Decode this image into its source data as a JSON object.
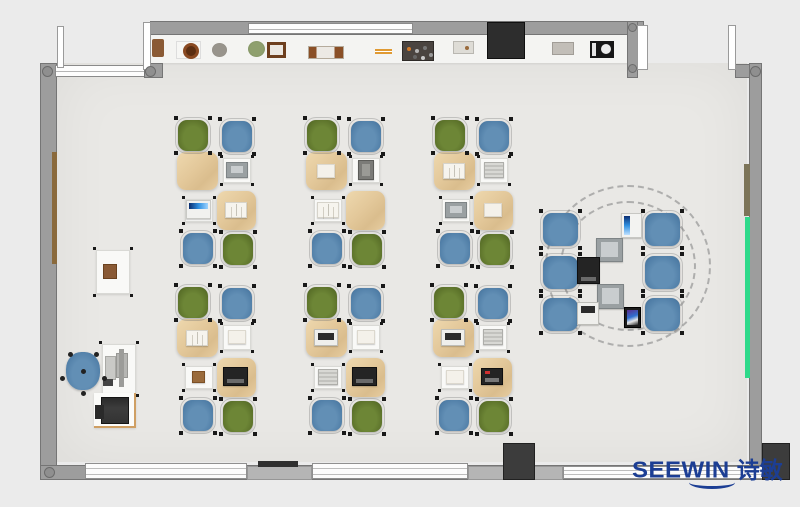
{
  "logo": {
    "en": "SEEWIN",
    "cn": "诗敏",
    "color": "#1c3e94"
  },
  "palette": {
    "background": "#ebebeb",
    "floor": "#e9e8e5",
    "wall": "#9d9d9d",
    "wall_dark": "#3c3c3c",
    "chair_green": "#62792e",
    "chair_blue": "#5585ad",
    "desk_tan": "#e5cba0",
    "desk_white": "#f9f9f7",
    "board_green": "#2ed98a",
    "board_brown": "#8a6a3c",
    "logo_blue": "#1c3e94"
  },
  "floor_rects": [
    {
      "name": "room-floor",
      "cls": "floor",
      "x": 57,
      "y": 63,
      "w": 690,
      "h": 399
    },
    {
      "name": "top-shelf-band",
      "cls": "shelfband",
      "x": 150,
      "y": 35,
      "w": 480,
      "h": 28
    }
  ],
  "zone_circles": [
    {
      "name": "collab-zone-outline-outer",
      "x": 545,
      "y": 185,
      "w": 166,
      "h": 162
    },
    {
      "name": "collab-zone-outline-inner",
      "x": 560,
      "y": 201,
      "w": 136,
      "h": 130
    }
  ],
  "cluster_template": {
    "chair_w": 30,
    "chair_h": 31,
    "chairs": [
      {
        "dx": 1,
        "dy": 2,
        "color": "green"
      },
      {
        "dx": 45,
        "dy": 3,
        "color": "blue"
      },
      {
        "dx": 6,
        "dy": 115,
        "color": "blue"
      },
      {
        "dx": 46,
        "dy": 116,
        "color": "green"
      }
    ],
    "desks": [
      {
        "dx": 0,
        "dy": 34,
        "w": 41,
        "h": 38,
        "kind": "tan"
      },
      {
        "dx": 46,
        "dy": 40,
        "w": 28,
        "h": 25,
        "kind": "white"
      },
      {
        "dx": 8,
        "dy": 81,
        "w": 28,
        "h": 23,
        "kind": "white"
      },
      {
        "dx": 40,
        "dy": 73,
        "w": 39,
        "h": 39,
        "kind": "tan"
      }
    ],
    "slots": {
      "tl": [
        20,
        53
      ],
      "tr": [
        60,
        52
      ],
      "bl": [
        22,
        92
      ],
      "br": [
        59,
        92
      ]
    },
    "device_sizes": {
      "default": [
        21,
        15
      ],
      "laptop-dark": [
        25,
        19
      ],
      "laptop-dark-red": [
        22,
        17
      ],
      "laptop-blue": [
        25,
        19
      ],
      "laptop-white": [
        24,
        17
      ],
      "laptop-gray": [
        22,
        16
      ],
      "book": [
        22,
        16
      ],
      "book-gray": [
        20,
        16
      ],
      "paper": [
        18,
        14
      ],
      "paper-small": [
        13,
        12
      ],
      "tablet-dark": [
        16,
        20
      ]
    }
  },
  "clusters": [
    {
      "x": 177,
      "y": 118,
      "devices": {
        "tr": "laptop-gray",
        "bl": "laptop-blue",
        "br": "book"
      }
    },
    {
      "x": 306,
      "y": 118,
      "devices": {
        "tl": "paper",
        "tr": "tablet-dark",
        "bl": "book"
      }
    },
    {
      "x": 434,
      "y": 118,
      "devices": {
        "tl": "book",
        "tr": "book-gray",
        "bl": "laptop-gray",
        "br": "paper"
      }
    },
    {
      "x": 177,
      "y": 285,
      "devices": {
        "tl": "book",
        "tr": "paper",
        "bl": "paper-small",
        "br": "laptop-dark"
      }
    },
    {
      "x": 306,
      "y": 285,
      "devices": {
        "tl": "laptop-white",
        "tr": "paper",
        "bl": "book-gray",
        "br": "laptop-dark"
      }
    },
    {
      "x": 433,
      "y": 285,
      "devices": {
        "tl": "laptop-white",
        "tr": "book-gray",
        "bl": "paper",
        "br": "laptop-dark-red"
      }
    }
  ],
  "collab": {
    "chair_w": 35,
    "chair_h": 33,
    "chairs": [
      {
        "x": 543,
        "y": 213
      },
      {
        "x": 543,
        "y": 256
      },
      {
        "x": 543,
        "y": 298
      },
      {
        "x": 645,
        "y": 213
      },
      {
        "x": 645,
        "y": 256
      },
      {
        "x": 645,
        "y": 298
      }
    ],
    "devices": [
      {
        "x": 621,
        "y": 213,
        "w": 21,
        "h": 25,
        "kind": "tablet-blue"
      },
      {
        "x": 596,
        "y": 238,
        "w": 27,
        "h": 24,
        "kind": "laptop-gray"
      },
      {
        "x": 577,
        "y": 257,
        "w": 23,
        "h": 27,
        "kind": "laptop-dark"
      },
      {
        "x": 597,
        "y": 284,
        "w": 27,
        "h": 25,
        "kind": "laptop-gray"
      },
      {
        "x": 577,
        "y": 302,
        "w": 22,
        "h": 23,
        "kind": "laptop-white"
      },
      {
        "x": 624,
        "y": 307,
        "w": 17,
        "h": 21,
        "kind": "phone-color"
      }
    ]
  },
  "teacher": {
    "chair": {
      "x": 66,
      "y": 352,
      "w": 34,
      "h": 38
    },
    "rects": [
      {
        "name": "side-desk",
        "cls": "desk-white",
        "x": 96,
        "y": 250,
        "w": 34,
        "h": 44,
        "feet": true
      },
      {
        "name": "side-desk-item",
        "cls": "item-brown",
        "x": 103,
        "y": 264,
        "w": 14,
        "h": 15
      },
      {
        "name": "teacher-desk",
        "cls": "desk-white",
        "x": 102,
        "y": 344,
        "w": 34,
        "h": 50,
        "feet": true
      },
      {
        "name": "monitor-panel-left",
        "cls": "mon-panel",
        "x": 105,
        "y": 356,
        "w": 11,
        "h": 24
      },
      {
        "name": "monitor-panel-right",
        "cls": "mon-panel2",
        "x": 116,
        "y": 353,
        "w": 12,
        "h": 25
      },
      {
        "name": "monitor-arm",
        "cls": "mon-bar",
        "x": 119,
        "y": 349,
        "w": 5,
        "h": 38
      },
      {
        "name": "desk-item-small",
        "cls": "item-dark-sm",
        "x": 103,
        "y": 379,
        "w": 10,
        "h": 7
      },
      {
        "name": "printer-mat",
        "cls": "mat",
        "x": 94,
        "y": 393,
        "w": 42,
        "h": 35
      },
      {
        "name": "printer",
        "cls": "printer",
        "x": 101,
        "y": 397,
        "w": 28,
        "h": 27
      }
    ]
  },
  "shelf_items": [
    {
      "name": "shelf-item-vase",
      "cls": "si-brown",
      "x": 152,
      "y": 39,
      "w": 12,
      "h": 18
    },
    {
      "name": "shelf-item-ring-pot",
      "cls": "si-pot",
      "x": 176,
      "y": 41,
      "w": 25,
      "h": 18
    },
    {
      "name": "shelf-item-round-pot",
      "cls": "si-circle",
      "x": 212,
      "y": 43,
      "w": 15,
      "h": 14
    },
    {
      "name": "shelf-item-plant",
      "cls": "si-plant",
      "x": 248,
      "y": 41,
      "w": 17,
      "h": 16
    },
    {
      "name": "shelf-item-frame",
      "cls": "si-frame",
      "x": 267,
      "y": 42,
      "w": 19,
      "h": 16
    },
    {
      "name": "shelf-item-books",
      "cls": "si-books",
      "x": 308,
      "y": 46,
      "w": 36,
      "h": 13
    },
    {
      "name": "shelf-item-pencils",
      "cls": "si-pencils",
      "x": 375,
      "y": 49,
      "w": 17,
      "h": 6
    },
    {
      "name": "shelf-item-toolboard",
      "cls": "si-pegboard",
      "x": 402,
      "y": 41,
      "w": 32,
      "h": 20
    },
    {
      "name": "shelf-item-tray",
      "cls": "si-box",
      "x": 453,
      "y": 41,
      "w": 21,
      "h": 13
    },
    {
      "name": "shelf-item-box",
      "cls": "si-box2",
      "x": 552,
      "y": 42,
      "w": 22,
      "h": 13
    },
    {
      "name": "shelf-item-speaker",
      "cls": "si-speaker",
      "x": 590,
      "y": 41,
      "w": 24,
      "h": 17
    }
  ],
  "walls": [
    {
      "name": "wall-top",
      "cls": "wall",
      "x": 150,
      "y": 21,
      "w": 494,
      "h": 14
    },
    {
      "name": "window-top",
      "cls": "winh",
      "x": 248,
      "y": 23,
      "w": 165,
      "h": 11
    },
    {
      "name": "cabinet-top",
      "cls": "cabinet",
      "x": 487,
      "y": 22,
      "w": 38,
      "h": 37
    },
    {
      "name": "wall-left",
      "cls": "wall",
      "x": 40,
      "y": 63,
      "w": 17,
      "h": 417
    },
    {
      "name": "window-topleft",
      "cls": "winh",
      "x": 55,
      "y": 65,
      "w": 91,
      "h": 12
    },
    {
      "name": "wall-topleft-pier",
      "cls": "wall",
      "x": 144,
      "y": 63,
      "w": 19,
      "h": 15
    },
    {
      "name": "wall-alcove",
      "cls": "wall",
      "x": 627,
      "y": 21,
      "w": 11,
      "h": 57
    },
    {
      "name": "wall-topright",
      "cls": "wall",
      "x": 735,
      "y": 64,
      "w": 26,
      "h": 14
    },
    {
      "name": "wall-right",
      "cls": "wall",
      "x": 749,
      "y": 63,
      "w": 13,
      "h": 417
    },
    {
      "name": "door-frame-a",
      "cls": "doorw",
      "x": 57,
      "y": 26,
      "w": 7,
      "h": 42
    },
    {
      "name": "door-frame-b",
      "cls": "doorw",
      "x": 143,
      "y": 22,
      "w": 8,
      "h": 48
    },
    {
      "name": "door-frame-c",
      "cls": "doorw",
      "x": 637,
      "y": 25,
      "w": 11,
      "h": 45
    },
    {
      "name": "door-frame-d",
      "cls": "doorw",
      "x": 728,
      "y": 25,
      "w": 8,
      "h": 45
    },
    {
      "name": "board-brown-left",
      "cls": "strip-brown",
      "x": 52,
      "y": 152,
      "w": 5,
      "h": 112
    },
    {
      "name": "board-olive-right",
      "cls": "strip-olive",
      "x": 744,
      "y": 164,
      "w": 6,
      "h": 52
    },
    {
      "name": "board-green-right",
      "cls": "strip-green",
      "x": 745,
      "y": 217,
      "w": 5,
      "h": 161
    },
    {
      "name": "wall-bottom",
      "cls": "wall",
      "x": 40,
      "y": 465,
      "w": 750,
      "h": 15
    },
    {
      "name": "window-bottom-1",
      "cls": "winh2",
      "x": 85,
      "y": 463,
      "w": 162,
      "h": 16
    },
    {
      "name": "pier-bottom-1",
      "cls": "pier-mid",
      "x": 247,
      "y": 466,
      "w": 65,
      "h": 14
    },
    {
      "name": "window-bottom-2",
      "cls": "winh2",
      "x": 312,
      "y": 463,
      "w": 156,
      "h": 16
    },
    {
      "name": "pier-bottom-2",
      "cls": "pier-mid",
      "x": 468,
      "y": 466,
      "w": 95,
      "h": 14
    },
    {
      "name": "window-bottom-3",
      "cls": "winh2",
      "x": 563,
      "y": 466,
      "w": 200,
      "h": 13
    },
    {
      "name": "sill-marker",
      "cls": "darkbar",
      "x": 258,
      "y": 461,
      "w": 40,
      "h": 6
    },
    {
      "name": "pier-dark-bottom",
      "cls": "pier-dark",
      "x": 503,
      "y": 443,
      "w": 32,
      "h": 37
    },
    {
      "name": "pier-dark-corner",
      "cls": "pier-dark",
      "x": 762,
      "y": 443,
      "w": 28,
      "h": 37
    }
  ],
  "dots": [
    {
      "name": "pier-cap-topleft",
      "x": 42,
      "y": 66,
      "d": 11
    },
    {
      "name": "pier-cap-topleft2",
      "x": 145,
      "y": 66,
      "d": 11
    },
    {
      "name": "pier-cap-alcove-top",
      "x": 628,
      "y": 23,
      "d": 9
    },
    {
      "name": "pier-cap-alcove-bottom",
      "x": 628,
      "y": 64,
      "d": 9
    },
    {
      "name": "pier-cap-topright",
      "x": 750,
      "y": 66,
      "d": 11
    },
    {
      "name": "pier-cap-bottomleft",
      "x": 44,
      "y": 467,
      "d": 11
    }
  ]
}
